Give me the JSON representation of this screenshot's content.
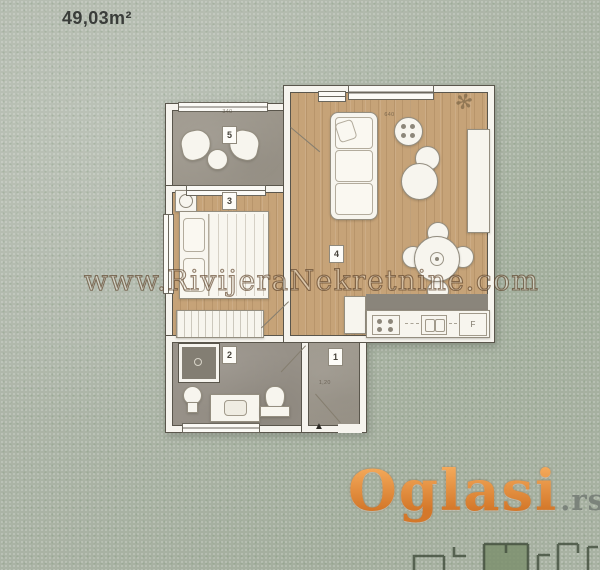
{
  "meta": {
    "area_label": "49,03m²"
  },
  "watermark": {
    "text": "www.RivijeraNekretnine.com"
  },
  "logo": {
    "name": "Oglasi",
    "tld": ".rs"
  },
  "floorplan": {
    "rooms": [
      {
        "label": "1",
        "name": "hallway"
      },
      {
        "label": "2",
        "name": "bathroom"
      },
      {
        "label": "3",
        "name": "bedroom"
      },
      {
        "label": "4",
        "name": "living-room"
      },
      {
        "label": "5",
        "name": "terrace"
      }
    ],
    "appliance_labels": {
      "fridge": "F"
    },
    "dimensions": [
      {
        "text": "340"
      },
      {
        "text": "640"
      },
      {
        "text": "1,20"
      }
    ]
  },
  "icons": {
    "entrance_marker": "▲",
    "plant": "✻"
  },
  "colors": {
    "background": "#aeb6a9",
    "wall": "#f6f4ee",
    "wall_outline": "#5a564c",
    "wood_floor": "#c6a378",
    "concrete_floor": "#9d978c",
    "logo_orange": "#d4782a",
    "logo_tld_gray": "#7b837b",
    "watermark_outline": "#52361c",
    "area_text": "#3a3d3a"
  }
}
